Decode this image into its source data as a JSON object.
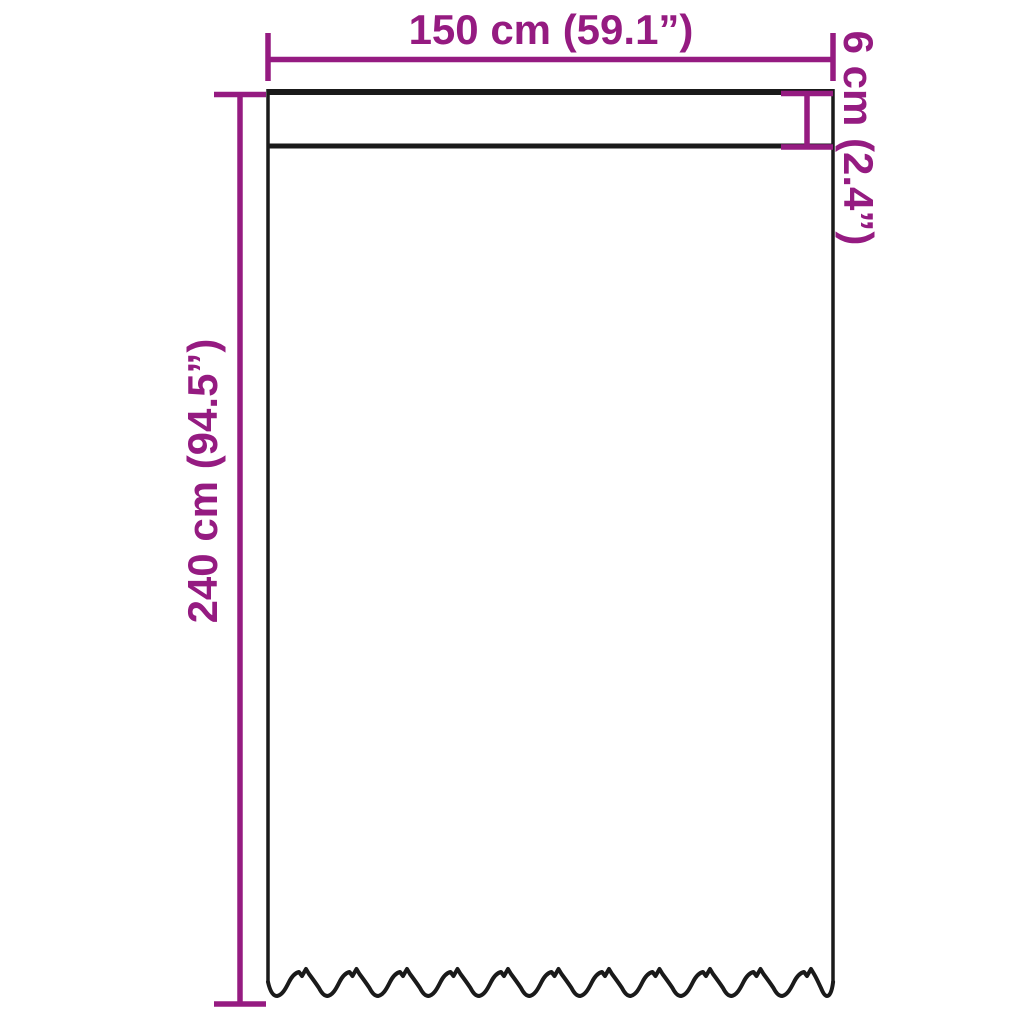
{
  "diagram": {
    "labels": {
      "width": "150 cm (59.1”)",
      "height": "240 cm (94.5”)",
      "header": "6 cm (2.4”)"
    },
    "dimensions": {
      "width_cm": 150,
      "width_inches": 59.1,
      "height_cm": 240,
      "height_inches": 94.5,
      "header_height_cm": 6,
      "header_height_inches": 2.4
    },
    "colors": {
      "dimension": "#951b81",
      "outline": "#1a1a1a",
      "background": "#ffffff"
    }
  }
}
